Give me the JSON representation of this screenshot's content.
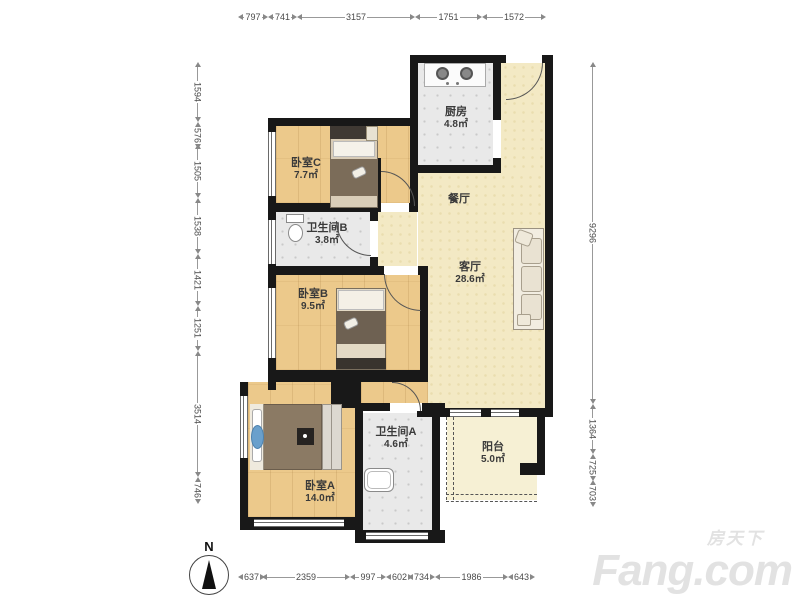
{
  "rooms": [
    {
      "id": "kitchen",
      "name": "厨房",
      "area": "4.8㎡"
    },
    {
      "id": "bedroomC",
      "name": "卧室C",
      "area": "7.7㎡"
    },
    {
      "id": "bathroomB",
      "name": "卫生间B",
      "area": "3.8㎡"
    },
    {
      "id": "dining",
      "name": "餐厅",
      "area": ""
    },
    {
      "id": "living",
      "name": "客厅",
      "area": "28.6㎡"
    },
    {
      "id": "bedroomB",
      "name": "卧室B",
      "area": "9.5㎡"
    },
    {
      "id": "bedroomA",
      "name": "卧室A",
      "area": "14.0㎡"
    },
    {
      "id": "bathroomA",
      "name": "卫生间A",
      "area": "4.6㎡"
    },
    {
      "id": "balcony",
      "name": "阳台",
      "area": "5.0㎡"
    }
  ],
  "dimensions": {
    "top": [
      "797",
      "741",
      "3157",
      "1751",
      "1572"
    ],
    "bottom": [
      "637",
      "2359",
      "997",
      "602",
      "734",
      "1986",
      "643"
    ],
    "left": [
      "1594",
      "576",
      "1505",
      "1538",
      "1421",
      "1251",
      "3514",
      "746"
    ],
    "right": [
      "9296",
      "1364",
      "725",
      "703"
    ]
  },
  "compass": {
    "label": "N"
  },
  "watermark": {
    "cn": "房天下",
    "en": "Fang.com"
  },
  "colors": {
    "wall": "#181818",
    "wood_floor": "#ecc98b",
    "hall_floor": "#f3e9c4",
    "tile_floor": "#e9e9e9",
    "balcony_floor": "#f6f0d4",
    "watermark": "#e2e2e2"
  }
}
